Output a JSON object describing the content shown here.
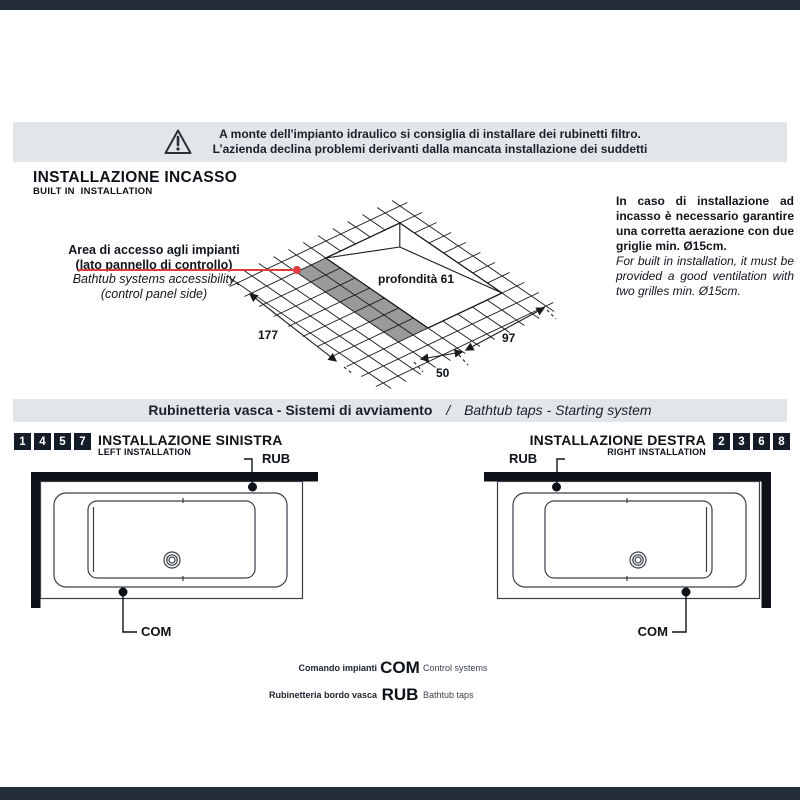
{
  "banner": {
    "line1": "A monte dell'impianto idraulico si consiglia di installare dei rubinetti filtro.",
    "line2": "L’azienda declina problemi derivanti dalla mancata installazione dei suddetti"
  },
  "section_incasso": {
    "title": "INSTALLAZIONE INCASSO",
    "subtitle": "BUILT IN  INSTALLATION",
    "annotation": {
      "it1": "Area di accesso agli impianti",
      "it2": "(lato pannello di controllo)",
      "en1": "Bathtub systems accessibility",
      "en2": "(control panel side)"
    },
    "diagram": {
      "depth_label": "profondità 61",
      "dim_left": "177",
      "dim_right": "97",
      "dim_small": "50"
    },
    "note_it": "In caso di installazione ad incasso è necessario garantire una corretta aerazione con due griglie min. Ø15cm.",
    "note_en": "For built in installation, it must be provided a good ventilation with two grilles min. Ø15cm."
  },
  "section_taps": {
    "title_it": "Rubinetteria vasca - Sistemi di avviamento",
    "separator": "/",
    "title_en": "Bathtub taps - Starting system",
    "left": {
      "numbers": [
        "1",
        "4",
        "5",
        "7"
      ],
      "title": "INSTALLAZIONE SINISTRA",
      "subtitle": "LEFT INSTALLATION",
      "rub": "RUB",
      "com": "COM"
    },
    "right": {
      "numbers": [
        "2",
        "3",
        "6",
        "8"
      ],
      "title": "INSTALLAZIONE DESTRA",
      "subtitle": "RIGHT INSTALLATION",
      "rub": "RUB",
      "com": "COM"
    },
    "legend": [
      {
        "it": "Comando impianti",
        "code": "COM",
        "en": "Control systems"
      },
      {
        "it": "Rubinetteria bordo vasca",
        "code": "RUB",
        "en": "Bathtub taps"
      }
    ]
  },
  "colors": {
    "accent_red": "#e23b3b",
    "band_bg": "#e3e6e8",
    "bar_bg": "#232d3a",
    "numbox_bg": "#131c28",
    "shaded_area": "#9a9a9a",
    "ink": "#10151c"
  }
}
